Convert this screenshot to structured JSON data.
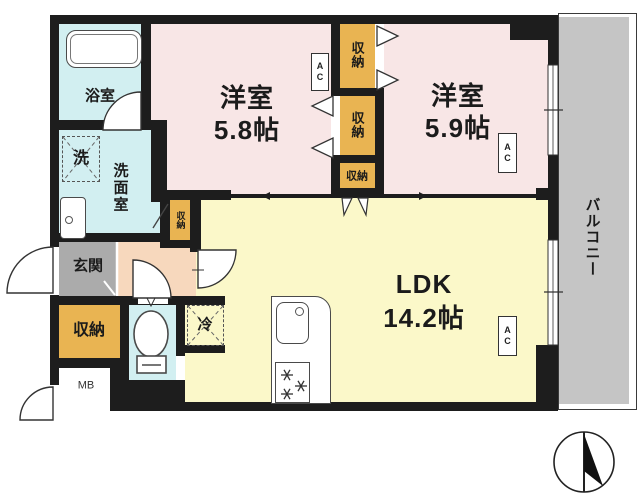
{
  "plan_title": "apartment-floor-plan",
  "labels": {
    "room1_name": "洋室",
    "room1_size": "5.8帖",
    "room2_name": "洋室",
    "room2_size": "5.9帖",
    "ldk_name": "LDK",
    "ldk_size": "14.2帖",
    "bathroom": "浴室",
    "washing_machine": "洗",
    "washroom": "洗面室",
    "entrance": "玄関",
    "storage": "収納",
    "meter_box": "MB",
    "refrigerator": "冷",
    "balcony": "バルコニー",
    "air_conditioner": "AC"
  },
  "colors": {
    "wall": "#1d1d1d",
    "western_room": "#f8e6e6",
    "ldk": "#fbf8c9",
    "wet_area": "#d2eff1",
    "storage": "#e9b452",
    "entrance": "#ababab",
    "hallway": "#f7d8bd",
    "balcony": "#c5c5c5"
  }
}
